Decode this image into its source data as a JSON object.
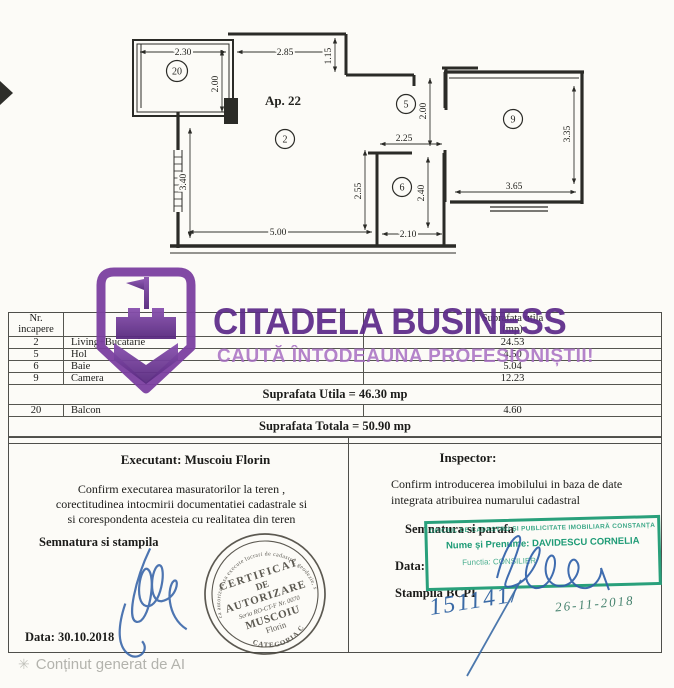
{
  "plan": {
    "apartment": "Ap. 22",
    "rooms": {
      "balcony": "20",
      "living": "2",
      "hall": "5",
      "bath": "6",
      "camera": "9"
    },
    "dims": {
      "balcony_w": "2.30",
      "balcony_h": "2.00",
      "living_top": "2.85",
      "entry_step": "1.15",
      "living_left": "3.40",
      "living_bottom": "5.00",
      "living_right": "2.55",
      "bath_top": "2.25",
      "bath_right": "2.40",
      "bath_bottom": "2.10",
      "hall_h": "2.00",
      "camera_w": "3.65",
      "camera_h": "3.35"
    }
  },
  "table": {
    "header": {
      "nr1": "Nr.",
      "nr2": "incapere",
      "name": "",
      "area1": "Suprafata utila",
      "area2": "(mp)"
    },
    "rows": [
      {
        "nr": "2",
        "name": "Living+Bucatarie",
        "area": "24.53"
      },
      {
        "nr": "5",
        "name": "Hol",
        "area": "4.50"
      },
      {
        "nr": "6",
        "name": "Baie",
        "area": "5.04"
      },
      {
        "nr": "9",
        "name": "Camera",
        "area": "12.23"
      }
    ],
    "utila": "Suprafata Utila = 46.30 mp",
    "balcon": {
      "nr": "20",
      "name": "Balcon",
      "area": "4.60"
    },
    "totala": "Suprafata Totala = 50.90 mp"
  },
  "executant": {
    "title": "Executant: Muscoiu Florin",
    "line1": "Confirm executarea masuratorilor la teren ,",
    "line2": "corectitudinea intocmirii documentatiei cadastrale si",
    "line3": "si corespondenta acesteia cu realitatea din teren",
    "sign_label": "Semnatura si stampila",
    "date": "Data: 30.10.2018",
    "stamp": {
      "arc_top": "Persoana fizica autorizata sa execute lucrari de cadastru, geodezie, si cartografie",
      "l1": "CERTIFICAT",
      "l2": "DE",
      "l3": "AUTORIZARE",
      "l4": "Seria RO-CT-F Nr. 0070",
      "l5": "MUSCOIU",
      "l6": "Florin",
      "arc_bottom": "CATEGORIA C"
    }
  },
  "inspector": {
    "title": "Inspector:",
    "line1": "Confirm introducerea imobilului in baza de date",
    "line2": "integrata atribuirea numarului cadastral",
    "sign_label": "Semnatura si parafa",
    "date_label": "Data:",
    "bcpi_label": "Stampila BCPI",
    "green_stamp": {
      "l1": "OFICIUL DE CADASTRU ȘI PUBLICITATE IMOBILIARĂ CONSTANȚA",
      "l2": "Nume și Prenume: DAVIDESCU CORNELIA",
      "l3": "Functia: CONSILIER"
    },
    "hand_number": "151141/",
    "hand_date": "26-11-2018"
  },
  "watermark": {
    "brand": "CITADELA BUSINESS",
    "tagline": "CAUTĂ ÎNTODEAUNA PROFESIONIȘTII!",
    "ai_icon": "✳",
    "ai_note": "Conținut generat de AI"
  },
  "colors": {
    "purple_dark": "#5d2b8a",
    "purple_light": "#a86fc3",
    "logo_purple": "#7b3fa0",
    "stamp_green": "#29a07b",
    "ink_blue": "#3a6aa6",
    "ink_teal": "#46826e"
  }
}
